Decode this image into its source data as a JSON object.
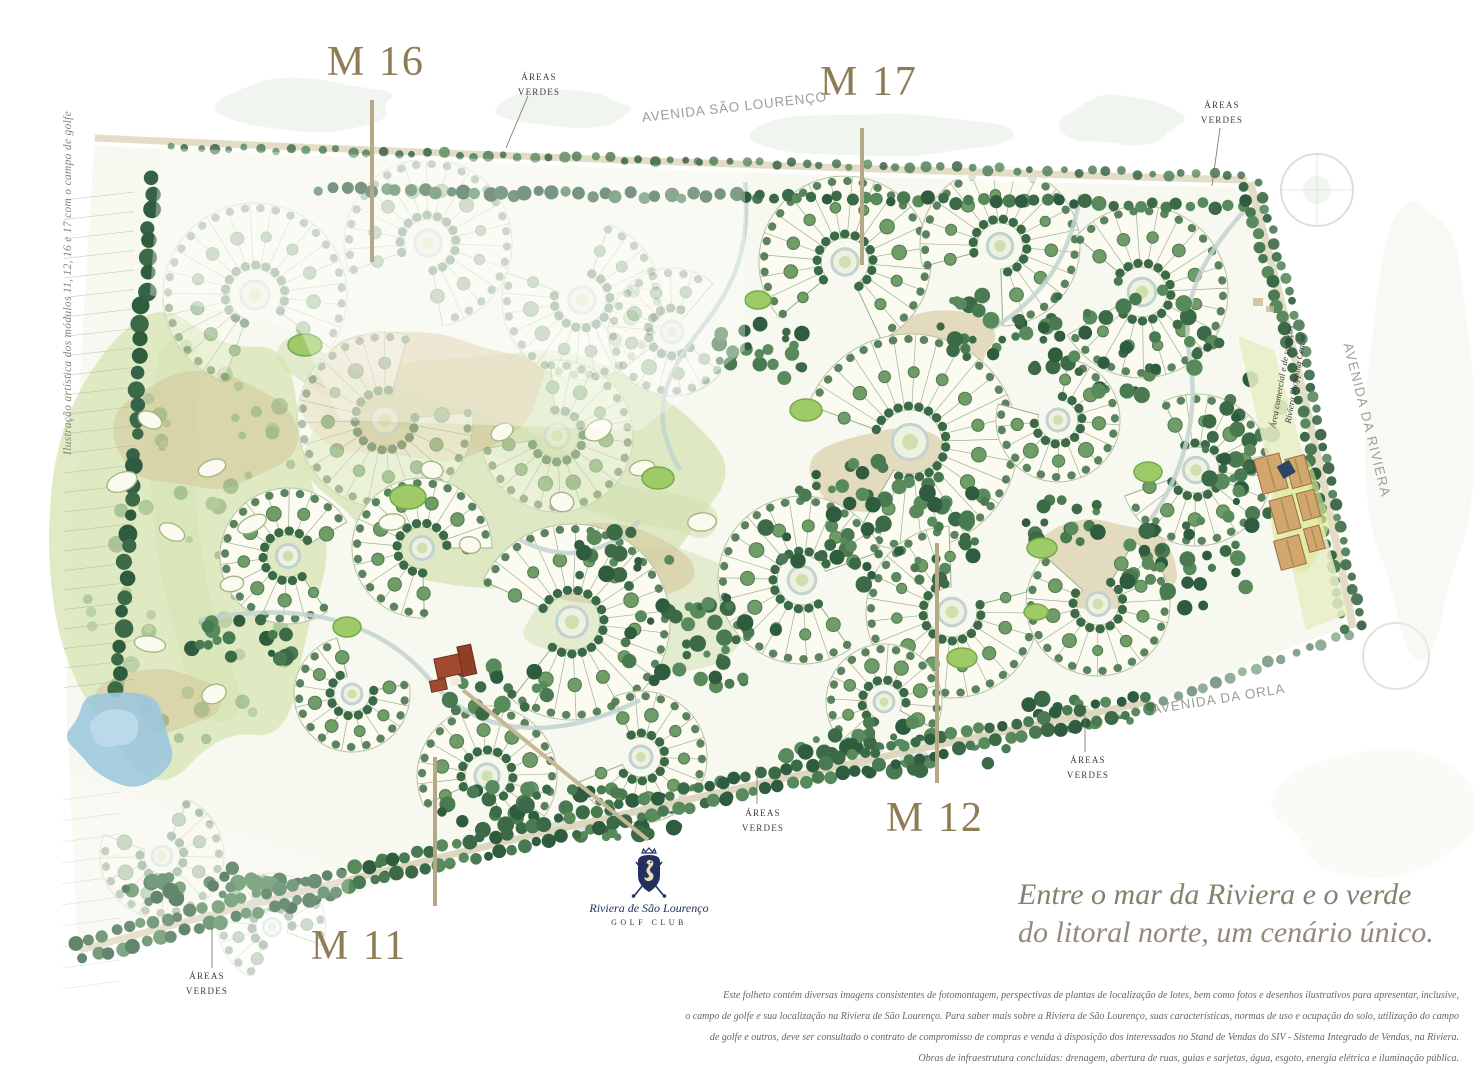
{
  "side_caption": "Ilustração artística dos módulos 11, 12, 16 e 17 com o campo de golfe",
  "modules": {
    "m16": "M 16",
    "m17": "M 17",
    "m12": "M 12",
    "m11": "M 11"
  },
  "green_area_label": {
    "line1": "ÁREAS",
    "line2": "VERDES"
  },
  "streets": {
    "sao_lourenco": "AVENIDA SÃO LOURENÇO",
    "riviera": "AVENIDA DA RIVIERA",
    "orla": "AVENIDA DA ORLA"
  },
  "commercial_area": {
    "line1": "Área comercial e de serviços",
    "line2": "Riviera Shopping Center"
  },
  "golf_club_logo": {
    "name": "Riviera de São Lourenço",
    "subtitle": "GOLF CLUB"
  },
  "tagline": {
    "line1": "Entre o mar da Riviera e o verde",
    "line2": "do litoral norte, um cenário único."
  },
  "disclaimer": {
    "lines": [
      "Este folheto contém diversas imagens consistentes de fotomontagem, perspectivas de plantas de localização de lotes, bem como fotos e desenhos ilustrativos para apresentar, inclusive,",
      "o campo de golfe e sua localização na Riviera de São Lourenço. Para saber mais sobre a Riviera de São Lourenço, suas características, normas de uso e ocupação do solo, utilização do campo",
      "de golfe e outros, deve ser consultado o contrato de compromisso de compras e venda à disposição dos interessados no Stand de Vendas do SIV - Sistema Integrado de Vendas, na Riviera.",
      "Obras de infraestrutura concluídas: drenagem, abertura de ruas, guias e sarjetas, água, esgoto, energia elétrica e iluminação pública."
    ]
  },
  "colors": {
    "module_label": "#8d7c55",
    "leader_line": "#b5a887",
    "street_label": "#9d9d99",
    "forest_dark": "#3c6a47",
    "golf_green": "#9ecb68",
    "water": "#9cc8de",
    "logo_navy": "#21305e",
    "tagline_text": "#87806f"
  }
}
